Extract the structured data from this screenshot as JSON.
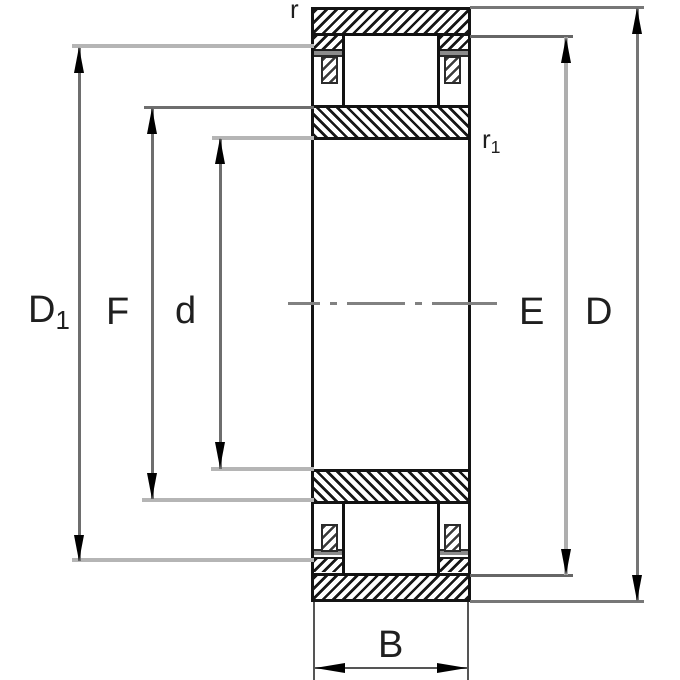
{
  "figure": {
    "kind": "bearing-cross-section-dimension-drawing",
    "colors": {
      "ink": "#141414",
      "dim_line_gray": "#6e6e6e",
      "extension_light_gray": "#b5b5b5",
      "flange_recess_gray": "#8c8c8c",
      "centerline_gray": "#818181",
      "background": "#ffffff"
    }
  },
  "labels": {
    "d1": {
      "main": "D",
      "sub": "1"
    },
    "f": {
      "main": "F"
    },
    "d": {
      "main": "d"
    },
    "e": {
      "main": "E"
    },
    "dcap": {
      "main": "D"
    },
    "b": {
      "main": "B"
    },
    "r": {
      "main": "r"
    },
    "r1": {
      "main": "r",
      "sub": "1"
    }
  }
}
